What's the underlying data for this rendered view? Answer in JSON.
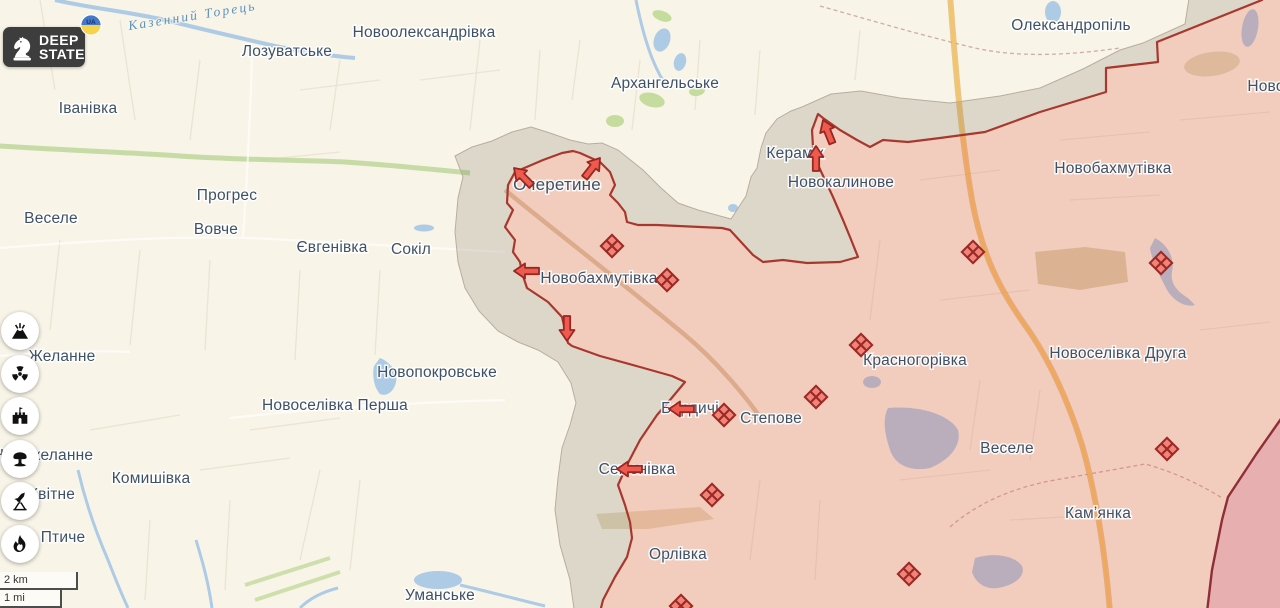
{
  "branding": {
    "logo_line1": "DEEP",
    "logo_line2": "STATE",
    "badge_text": "UA"
  },
  "scale": {
    "km": "2 km",
    "mi": "1 mi"
  },
  "sidebar": {
    "buttons": [
      {
        "icon": "volcano-icon"
      },
      {
        "icon": "radiation-icon"
      },
      {
        "icon": "fort-icon"
      },
      {
        "icon": "mushroom-cloud-icon"
      },
      {
        "icon": "rocket-icon"
      },
      {
        "icon": "flame-icon"
      }
    ]
  },
  "colors": {
    "settlement_label": "#3f5166",
    "water_label": "#5e93bd",
    "clash_fill": "#f0837a",
    "clash_stroke": "#9c2a24",
    "arrow_fill": "#ee5a4e",
    "arrow_stroke": "#982722",
    "occupied_fill": "#e2553e",
    "occupied_opacity": 0.24,
    "occupied_stroke": "#a8382e",
    "contested_fill": "#8a7f70",
    "contested_opacity": 0.25,
    "contested_edge": "#b8ae9f",
    "pre2022_fill": "#c95a86",
    "pre2022_opacity": 0.26,
    "pre2022_stroke": "#8e2f38"
  },
  "map": {
    "river_label": {
      "name": "Казенний Торець",
      "x": 193,
      "y": 20,
      "angle": -9
    },
    "settlement_labels": [
      {
        "name": "Новоолександрівка",
        "x": 424,
        "y": 37,
        "zone": "free"
      },
      {
        "name": "Лозуватське",
        "x": 287,
        "y": 56,
        "zone": "free"
      },
      {
        "name": "Архангельське",
        "x": 665,
        "y": 88,
        "zone": "free"
      },
      {
        "name": "Олександропіль",
        "x": 1071,
        "y": 30,
        "zone": "free"
      },
      {
        "name": "Іванівка",
        "x": 88,
        "y": 113,
        "zone": "free"
      },
      {
        "name": "Прогрес",
        "x": 227,
        "y": 200,
        "zone": "free"
      },
      {
        "name": "Веселе",
        "x": 51,
        "y": 223,
        "zone": "free"
      },
      {
        "name": "Вовче",
        "x": 216,
        "y": 234,
        "zone": "free"
      },
      {
        "name": "Євгенівка",
        "x": 332,
        "y": 252,
        "zone": "free"
      },
      {
        "name": "Сокіл",
        "x": 411,
        "y": 254,
        "zone": "free"
      },
      {
        "name": "Желанне",
        "x": 62,
        "y": 361,
        "zone": "free"
      },
      {
        "name": "Новопокровське",
        "x": 437,
        "y": 377,
        "zone": "free"
      },
      {
        "name": "Новоселівка Перша",
        "x": 335,
        "y": 410,
        "zone": "free"
      },
      {
        "name": "Новожеланне",
        "x": 43,
        "y": 460,
        "zone": "free"
      },
      {
        "name": "Комишівка",
        "x": 151,
        "y": 483,
        "zone": "free"
      },
      {
        "name": "Квітне",
        "x": 52,
        "y": 499,
        "zone": "free"
      },
      {
        "name": "Птиче",
        "x": 63,
        "y": 542,
        "zone": "free"
      },
      {
        "name": "Уманське",
        "x": 440,
        "y": 600,
        "zone": "free"
      },
      {
        "name": "Очеретине",
        "x": 557,
        "y": 190,
        "zone": "occupied",
        "s": 17
      },
      {
        "name": "Керамік",
        "x": 795,
        "y": 158,
        "zone": "occupied"
      },
      {
        "name": "Новокалинове",
        "x": 841,
        "y": 187,
        "zone": "occupied"
      },
      {
        "name": "Новобахмутівка",
        "x": 599,
        "y": 283,
        "zone": "occupied"
      },
      {
        "name": "Новобахмутівка",
        "x": 1113,
        "y": 173,
        "zone": "occupied"
      },
      {
        "name": "Новоселівка Друга",
        "x": 1118,
        "y": 358,
        "zone": "occupied"
      },
      {
        "name": "Красногорівка",
        "x": 915,
        "y": 365,
        "zone": "occupied"
      },
      {
        "name": "Степове",
        "x": 771,
        "y": 423,
        "zone": "occupied"
      },
      {
        "name": "Веселе",
        "x": 1007,
        "y": 453,
        "zone": "occupied"
      },
      {
        "name": "Камʼянка",
        "x": 1098,
        "y": 518,
        "zone": "occupied"
      },
      {
        "name": "Бердичі",
        "x": 690,
        "y": 413,
        "zone": "occupied"
      },
      {
        "name": "Семенівка",
        "x": 637,
        "y": 474,
        "zone": "occupied"
      },
      {
        "name": "Орлівка",
        "x": 678,
        "y": 559,
        "zone": "occupied"
      },
      {
        "name": "Ново",
        "x": 1266,
        "y": 91,
        "zone": "occupied"
      }
    ],
    "clash_markers": [
      [
        612,
        246
      ],
      [
        667,
        280
      ],
      [
        973,
        252
      ],
      [
        1161,
        263
      ],
      [
        861,
        345
      ],
      [
        816,
        397
      ],
      [
        724,
        415
      ],
      [
        712,
        495
      ],
      [
        1167,
        449
      ],
      [
        909,
        574
      ],
      [
        681,
        606
      ]
    ],
    "advance_arrows": [
      {
        "x": 514,
        "y": 168,
        "angle": -135
      },
      {
        "x": 600,
        "y": 158,
        "angle": -52
      },
      {
        "x": 514,
        "y": 271,
        "angle": 180
      },
      {
        "x": 567,
        "y": 341,
        "angle": 90
      },
      {
        "x": 823,
        "y": 120,
        "angle": -112
      },
      {
        "x": 816,
        "y": 146,
        "angle": -90
      },
      {
        "x": 669,
        "y": 409,
        "angle": 180
      },
      {
        "x": 617,
        "y": 469,
        "angle": 180
      }
    ]
  }
}
